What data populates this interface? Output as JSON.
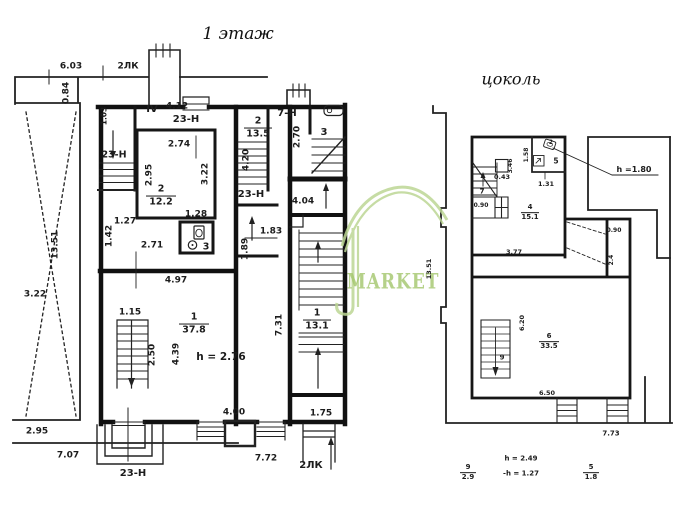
{
  "page": {
    "background": "#ffffff",
    "ink": "#1c1c1c",
    "watermark_green": "#b9d48f"
  },
  "titles": {
    "floor1": "1 этаж",
    "basement": "цоколь"
  },
  "watermark": {
    "text": "MARKET",
    "logo": "umbrella-hook-mark"
  },
  "floor1": {
    "labels": [
      {
        "text": "6.03",
        "x": 71,
        "y": 67
      },
      {
        "text": "2ЛК",
        "x": 128,
        "y": 67
      },
      {
        "text": "0.84",
        "x": 67,
        "y": 93,
        "rot": -90
      },
      {
        "text": "1.03",
        "x": 104,
        "y": 116,
        "rot": -90,
        "size": 7.5
      },
      {
        "text": "IV",
        "x": 152,
        "y": 110,
        "size": 10
      },
      {
        "text": "4.12",
        "x": 177,
        "y": 107
      },
      {
        "text": "23-Н",
        "x": 186,
        "y": 120,
        "size": 10
      },
      {
        "text": "2.74",
        "x": 179,
        "y": 145
      },
      {
        "text": "23-Н",
        "x": 114,
        "y": 155,
        "size": 9.5
      },
      {
        "text": "2.95",
        "x": 150,
        "y": 175,
        "rot": -90
      },
      {
        "text": "3.22",
        "x": 206,
        "y": 174,
        "rot": -90
      },
      {
        "text": "1.27",
        "x": 125,
        "y": 222
      },
      {
        "text": "1.42",
        "x": 110,
        "y": 236,
        "rot": -90
      },
      {
        "text": "1.28",
        "x": 196,
        "y": 215
      },
      {
        "text": "3",
        "x": 206,
        "y": 247,
        "size": 9.5
      },
      {
        "text": "2.71",
        "x": 152,
        "y": 246
      },
      {
        "text": "7-Н",
        "x": 287,
        "y": 114,
        "size": 10
      },
      {
        "text": "2.70",
        "x": 298,
        "y": 137,
        "rot": -90
      },
      {
        "text": "3",
        "x": 324,
        "y": 133,
        "size": 10
      },
      {
        "text": "23-Н",
        "x": 251,
        "y": 195,
        "size": 10
      },
      {
        "text": "4.04",
        "x": 303,
        "y": 202
      },
      {
        "text": "1.83",
        "x": 271,
        "y": 232
      },
      {
        "text": "1.89",
        "x": 246,
        "y": 249,
        "rot": -90
      },
      {
        "text": "4.20",
        "x": 247,
        "y": 160,
        "rot": -90
      },
      {
        "text": "4.97",
        "x": 176,
        "y": 281
      },
      {
        "text": "1.15",
        "x": 130,
        "y": 313
      },
      {
        "text": "2.50",
        "x": 153,
        "y": 355,
        "rot": -90
      },
      {
        "text": "4.39",
        "x": 177,
        "y": 354,
        "rot": -90
      },
      {
        "text": "h = 2.76",
        "x": 221,
        "y": 357,
        "size": 10.5
      },
      {
        "text": "7.31",
        "x": 280,
        "y": 325,
        "rot": -90
      },
      {
        "text": "4.00",
        "x": 234,
        "y": 413
      },
      {
        "text": "1.75",
        "x": 321,
        "y": 414
      },
      {
        "text": "2.95",
        "x": 37,
        "y": 432
      },
      {
        "text": "7.07",
        "x": 68,
        "y": 456
      },
      {
        "text": "23-Н",
        "x": 133,
        "y": 474,
        "size": 10
      },
      {
        "text": "7.72",
        "x": 266,
        "y": 459
      },
      {
        "text": "2ЛК",
        "x": 311,
        "y": 466,
        "size": 10
      },
      {
        "text": "3.22",
        "x": 35,
        "y": 295
      },
      {
        "text": "13.51",
        "x": 56,
        "y": 245,
        "rot": -90
      }
    ],
    "fractions": [
      {
        "num": "2",
        "den": "12.2",
        "x": 161,
        "y": 196,
        "size": 9.5,
        "lw": 30
      },
      {
        "num": "2",
        "den": "13.5",
        "x": 258,
        "y": 128,
        "size": 9.5,
        "lw": 28
      },
      {
        "num": "1",
        "den": "37.8",
        "x": 194,
        "y": 324,
        "size": 9.5,
        "lw": 30
      },
      {
        "num": "1",
        "den": "13.1",
        "x": 317,
        "y": 320,
        "size": 9.5,
        "lw": 28
      }
    ]
  },
  "basement": {
    "labels": [
      {
        "text": "h =1.80",
        "x": 634,
        "y": 170,
        "size": 8
      },
      {
        "text": "2",
        "x": 551,
        "y": 143,
        "size": 6
      },
      {
        "text": "5",
        "x": 556,
        "y": 161,
        "size": 7.5
      },
      {
        "text": "1.58",
        "x": 527,
        "y": 155,
        "rot": -90,
        "size": 6
      },
      {
        "text": "1.31",
        "x": 546,
        "y": 184,
        "size": 6.5
      },
      {
        "text": "0.43",
        "x": 502,
        "y": 177,
        "size": 6.5
      },
      {
        "text": "3.46",
        "x": 511,
        "y": 166,
        "rot": -90,
        "size": 6
      },
      {
        "text": "7",
        "x": 482,
        "y": 192,
        "size": 7
      },
      {
        "text": "0.90",
        "x": 481,
        "y": 206,
        "size": 6
      },
      {
        "text": "3.77",
        "x": 514,
        "y": 252,
        "size": 6.5
      },
      {
        "text": "0.90",
        "x": 614,
        "y": 231,
        "size": 6
      },
      {
        "text": "2.4",
        "x": 612,
        "y": 260,
        "rot": -90,
        "size": 6
      },
      {
        "text": "6.20",
        "x": 522,
        "y": 323,
        "rot": -90,
        "size": 6.5
      },
      {
        "text": "9",
        "x": 502,
        "y": 358,
        "size": 7
      },
      {
        "text": "6.50",
        "x": 547,
        "y": 393,
        "size": 6.5
      },
      {
        "text": "7.73",
        "x": 611,
        "y": 434,
        "size": 7
      },
      {
        "text": "13.51",
        "x": 429,
        "y": 269,
        "rot": -90,
        "size": 6.5
      }
    ],
    "fractions": [
      {
        "num": "4",
        "den": "15.1",
        "x": 530,
        "y": 213,
        "size": 7,
        "lw": 18
      },
      {
        "num": "6",
        "den": "33.5",
        "x": 549,
        "y": 342,
        "size": 7,
        "lw": 20
      }
    ]
  },
  "notes": {
    "labels": [
      {
        "text": "h = 2.49",
        "x": 521,
        "y": 459,
        "size": 7
      },
      {
        "text": "-h = 1.27",
        "x": 521,
        "y": 474,
        "size": 7
      }
    ],
    "fractions": [
      {
        "num": "9",
        "den": "2.9",
        "x": 468,
        "y": 473,
        "size": 7,
        "lw": 16
      },
      {
        "num": "5",
        "den": "1.8",
        "x": 591,
        "y": 473,
        "size": 7,
        "lw": 16
      }
    ]
  }
}
